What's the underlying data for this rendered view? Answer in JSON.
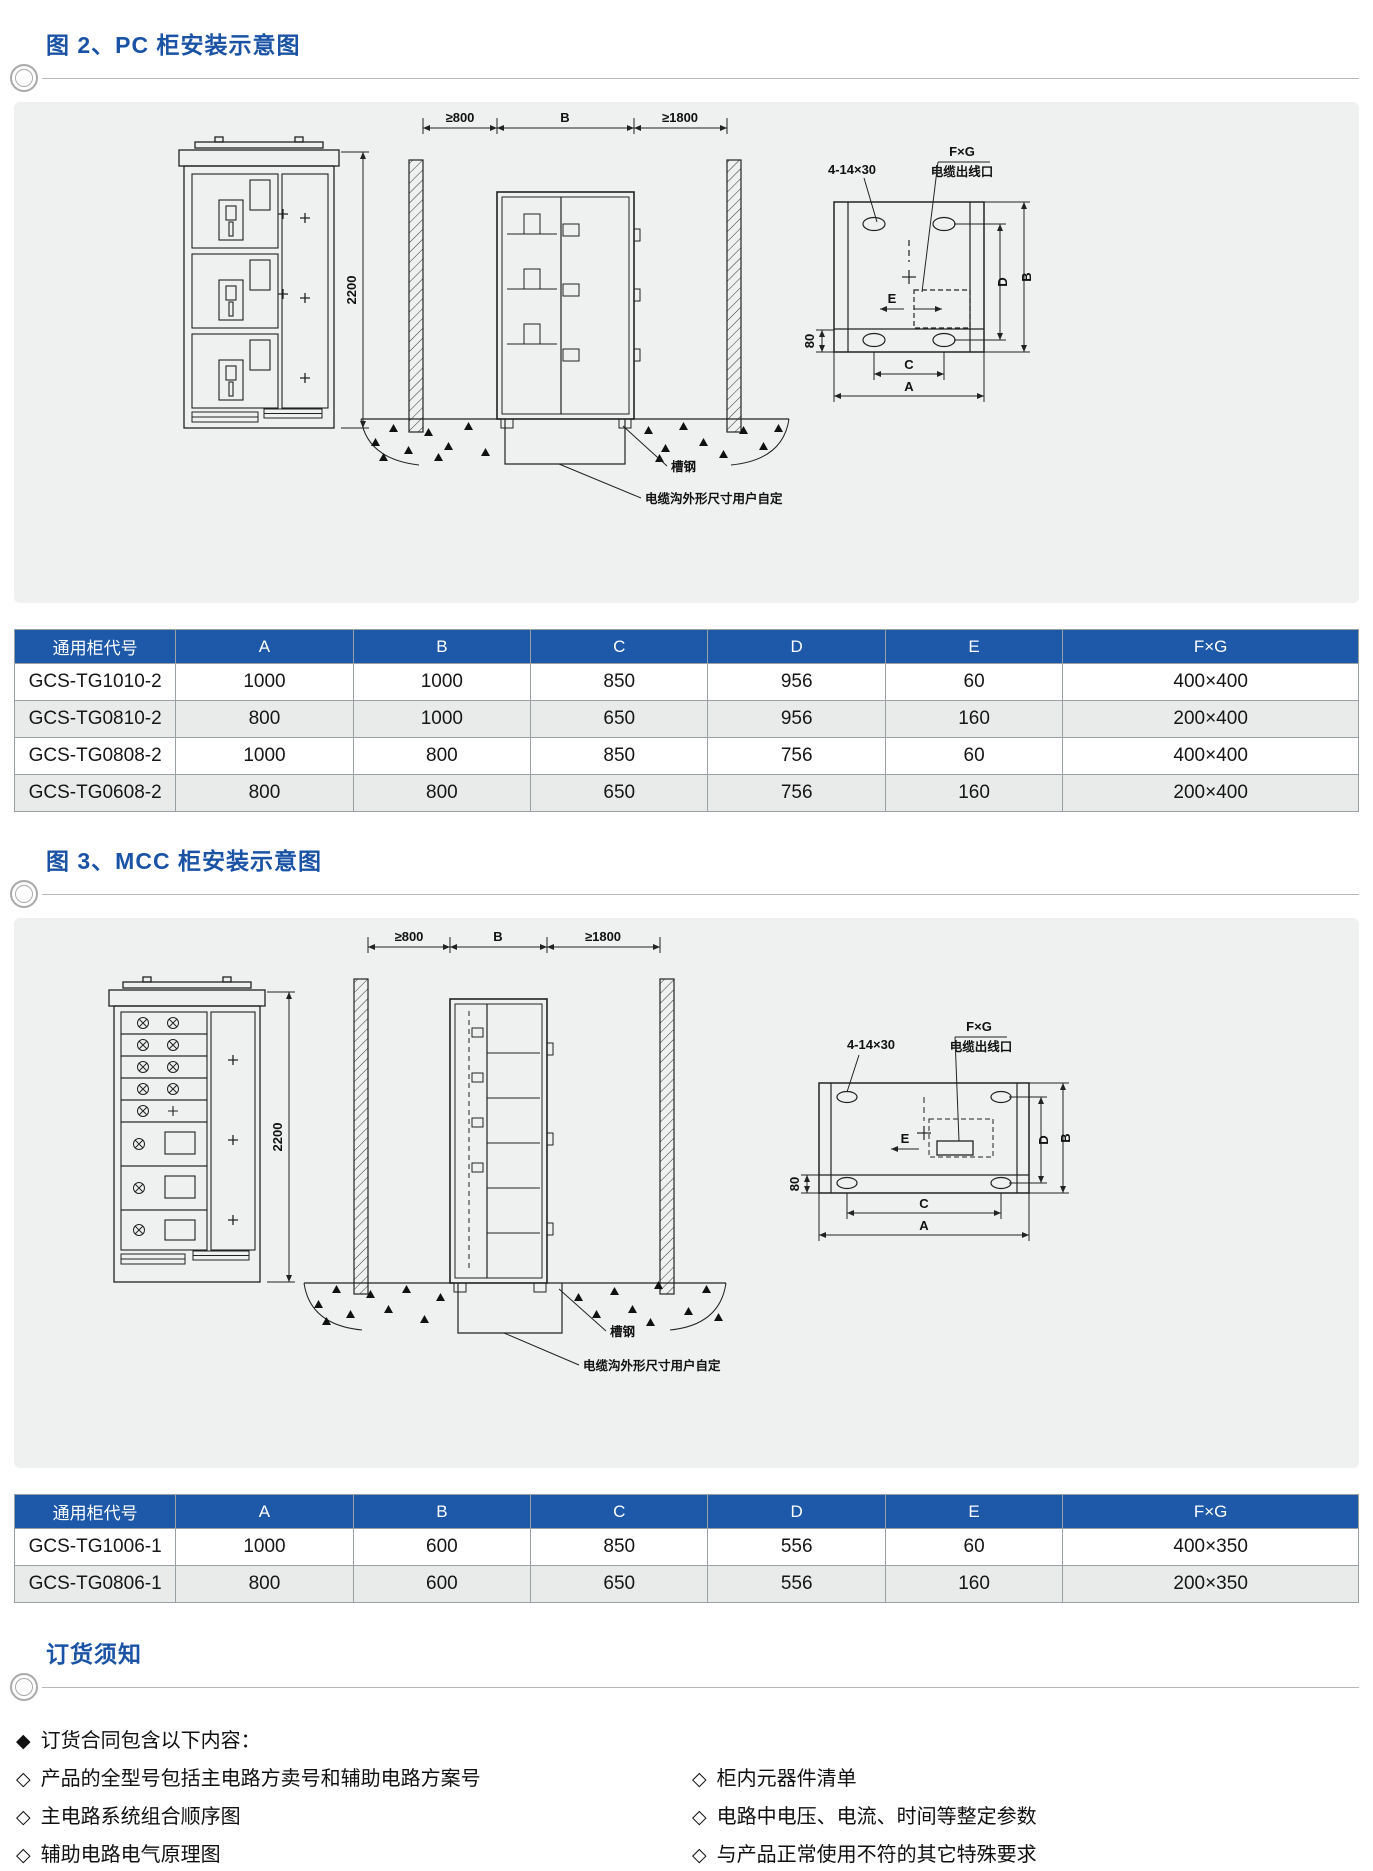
{
  "fig2": {
    "title": "图 2、PC 柜安装示意图",
    "labels": {
      "clearance_left": "≥800",
      "width_b": "B",
      "clearance_right": "≥1800",
      "height": "2200",
      "holes": "4-14×30",
      "fxg": "F×G",
      "cable_outlet": "电缆出线口",
      "channel_steel": "槽钢",
      "trench_note": "电缆沟外形尺寸用户自定",
      "dim_e": "E",
      "dim_80": "80",
      "dim_c": "C",
      "dim_a": "A",
      "dim_d": "D",
      "dim_b": "B"
    }
  },
  "table1": {
    "headers": [
      "通用柜代号",
      "A",
      "B",
      "C",
      "D",
      "E",
      "F×G"
    ],
    "rows": [
      [
        "GCS-TG1010-2",
        "1000",
        "1000",
        "850",
        "956",
        "60",
        "400×400"
      ],
      [
        "GCS-TG0810-2",
        "800",
        "1000",
        "650",
        "956",
        "160",
        "200×400"
      ],
      [
        "GCS-TG0808-2",
        "1000",
        "800",
        "850",
        "756",
        "60",
        "400×400"
      ],
      [
        "GCS-TG0608-2",
        "800",
        "800",
        "650",
        "756",
        "160",
        "200×400"
      ]
    ]
  },
  "fig3": {
    "title": "图 3、MCC 柜安装示意图",
    "labels": {
      "clearance_left": "≥800",
      "width_b": "B",
      "clearance_right": "≥1800",
      "height": "2200",
      "holes": "4-14×30",
      "fxg": "F×G",
      "cable_outlet": "电缆出线口",
      "channel_steel": "槽钢",
      "trench_note": "电缆沟外形尺寸用户自定",
      "dim_e": "E",
      "dim_80": "80",
      "dim_c": "C",
      "dim_a": "A",
      "dim_d": "D",
      "dim_b": "B"
    }
  },
  "table2": {
    "headers": [
      "通用柜代号",
      "A",
      "B",
      "C",
      "D",
      "E",
      "F×G"
    ],
    "rows": [
      [
        "GCS-TG1006-1",
        "1000",
        "600",
        "850",
        "556",
        "60",
        "400×350"
      ],
      [
        "GCS-TG0806-1",
        "800",
        "600",
        "650",
        "556",
        "160",
        "200×350"
      ]
    ]
  },
  "notes": {
    "section_title": "订货须知",
    "intro_bullet": "◆",
    "item_bullet": "◇",
    "intro": "订货合同包含以下内容：",
    "left": [
      "产品的全型号包括主电路方卖号和辅助电路方案号",
      "主电路系统组合顺序图",
      "辅助电路电气原理图"
    ],
    "right": [
      "柜内元器件清单",
      "电路中电压、电流、时间等整定参数",
      "与产品正常使用不符的其它特殊要求"
    ]
  }
}
